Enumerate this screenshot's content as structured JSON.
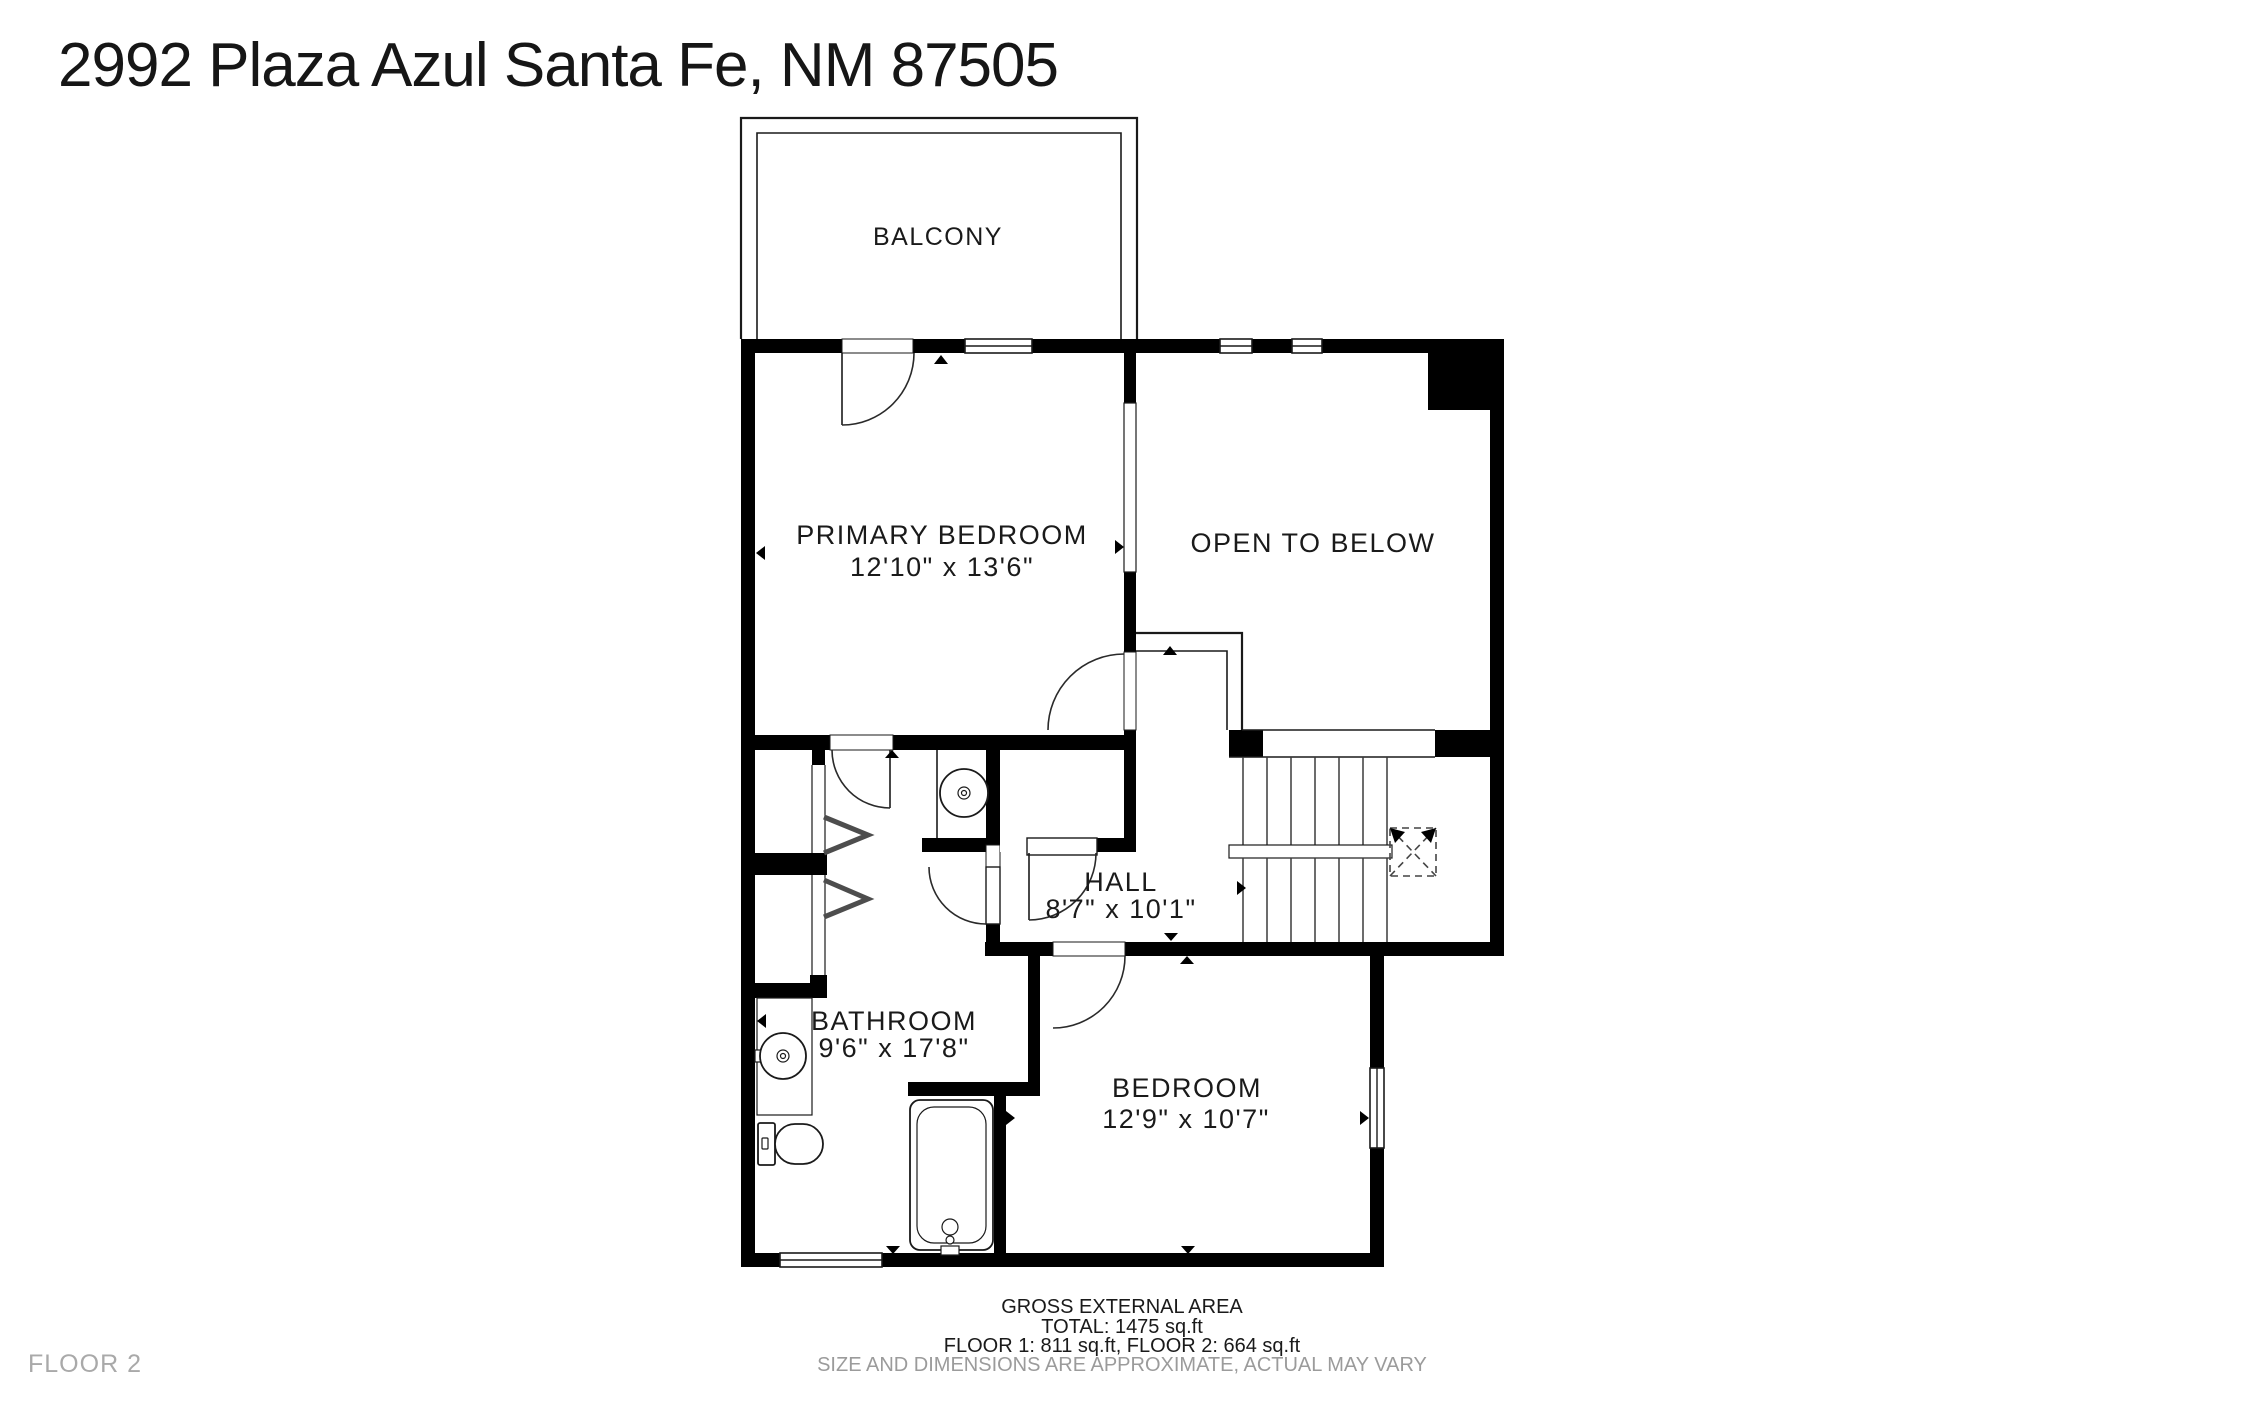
{
  "header": {
    "title": "2992 Plaza Azul Santa Fe, NM 87505"
  },
  "floor_plan": {
    "rooms": {
      "balcony": {
        "name": "BALCONY"
      },
      "primary_bedroom": {
        "name": "PRIMARY BEDROOM",
        "dims": "12'10\" x 13'6\""
      },
      "open_to_below": {
        "name": "OPEN TO BELOW"
      },
      "hall": {
        "name": "HALL",
        "dims": "8'7\" x 10'1\""
      },
      "bathroom": {
        "name": "BATHROOM",
        "dims": "9'6\" x 17'8\""
      },
      "bedroom": {
        "name": "BEDROOM",
        "dims": "12'9\" x 10'7\""
      }
    }
  },
  "footer": {
    "area_title": "GROSS EXTERNAL AREA",
    "total": "TOTAL: 1475 sq.ft",
    "floor_breakdown": "FLOOR 1: 811 sq.ft, FLOOR 2: 664 sq.ft",
    "disclaimer": "SIZE AND DIMENSIONS ARE APPROXIMATE, ACTUAL MAY VARY",
    "floor_label": "FLOOR 2"
  },
  "colors": {
    "walls": "#000000",
    "text": "#1a1a1a",
    "muted": "#9b9b9b"
  }
}
